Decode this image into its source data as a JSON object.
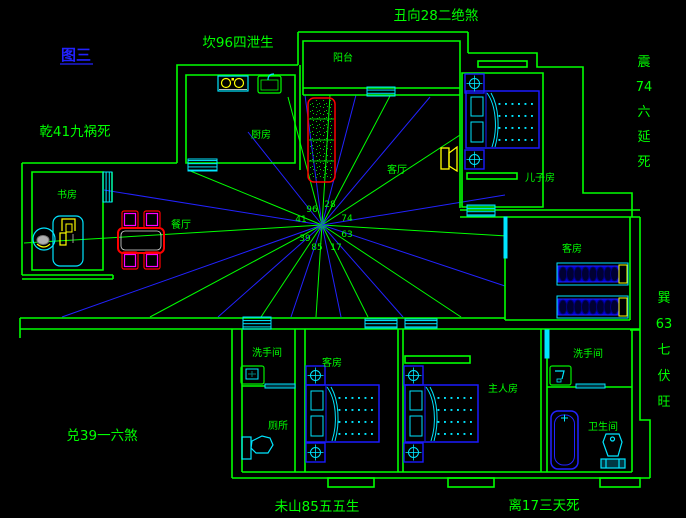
{
  "drawing_title": {
    "label": "图三"
  },
  "fengshui": {
    "top": "丑向28二绝煞",
    "north_west_upper": "坎96四泄生",
    "west_upper": "乾41九祸死",
    "west_lower": "兑39一六煞",
    "south_center": "未山85五五生",
    "south_east": "离17三天死",
    "east_upper_column": [
      "震",
      "74",
      "六",
      "延",
      "死"
    ],
    "east_lower_column": [
      "巽",
      "63",
      "七",
      "伏",
      "旺"
    ]
  },
  "rooms": {
    "balcony": {
      "label": "阳台"
    },
    "kitchen": {
      "label": "厨房"
    },
    "living": {
      "label": "客厅"
    },
    "son_room": {
      "label": "儿子房"
    },
    "study": {
      "label": "书房"
    },
    "dining": {
      "label": "餐厅"
    },
    "guest_right": {
      "label": "客房"
    },
    "washroom_left": {
      "label": "洗手间"
    },
    "toilet": {
      "label": "厕所"
    },
    "guest_bottom": {
      "label": "客房"
    },
    "master": {
      "label": "主人房"
    },
    "washroom_right": {
      "label": "洗手间"
    },
    "bathroom": {
      "label": "卫生间"
    }
  },
  "compass": {
    "center": {
      "x": 322,
      "y": 225
    },
    "numbers": [
      {
        "value": "96",
        "x": 312,
        "y": 212
      },
      {
        "value": "28",
        "x": 330,
        "y": 207
      },
      {
        "value": "41",
        "x": 301,
        "y": 222
      },
      {
        "value": "74",
        "x": 347,
        "y": 221
      },
      {
        "value": "39",
        "x": 305,
        "y": 241
      },
      {
        "value": "63",
        "x": 347,
        "y": 237
      },
      {
        "value": "85",
        "x": 317,
        "y": 250
      },
      {
        "value": "17",
        "x": 336,
        "y": 250
      }
    ],
    "rays": [
      {
        "x2": 507,
        "y2": 236,
        "color": "green"
      },
      {
        "x2": 505,
        "y2": 286,
        "color": "blue"
      },
      {
        "x2": 461,
        "y2": 317,
        "color": "green"
      },
      {
        "x2": 403,
        "y2": 317,
        "color": "blue"
      },
      {
        "x2": 368,
        "y2": 317,
        "color": "green"
      },
      {
        "x2": 341,
        "y2": 317,
        "color": "blue"
      },
      {
        "x2": 316,
        "y2": 317,
        "color": "green"
      },
      {
        "x2": 291,
        "y2": 317,
        "color": "blue"
      },
      {
        "x2": 261,
        "y2": 317,
        "color": "green"
      },
      {
        "x2": 218,
        "y2": 317,
        "color": "blue"
      },
      {
        "x2": 150,
        "y2": 317,
        "color": "green"
      },
      {
        "x2": 62,
        "y2": 317,
        "color": "blue"
      },
      {
        "x2": 24,
        "y2": 243,
        "color": "green"
      },
      {
        "x2": 104,
        "y2": 190,
        "color": "blue"
      },
      {
        "x2": 188,
        "y2": 170,
        "color": "green"
      },
      {
        "x2": 248,
        "y2": 132,
        "color": "blue"
      },
      {
        "x2": 288,
        "y2": 97,
        "color": "green"
      },
      {
        "x2": 305,
        "y2": 95,
        "color": "blue"
      },
      {
        "x2": 330,
        "y2": 95,
        "color": "green"
      },
      {
        "x2": 356,
        "y2": 95,
        "color": "blue"
      },
      {
        "x2": 390,
        "y2": 96,
        "color": "green"
      },
      {
        "x2": 430,
        "y2": 97,
        "color": "blue"
      },
      {
        "x2": 460,
        "y2": 135,
        "color": "green"
      },
      {
        "x2": 505,
        "y2": 195,
        "color": "blue"
      }
    ]
  },
  "colors": {
    "background": "#000000",
    "wall_green": "#00ff00",
    "ray_blue": "#2222ff",
    "furniture_blue": "#1a1aff",
    "cyan": "#00e5ff",
    "red": "#ff0000",
    "magenta": "#ff00ff",
    "yellow": "#ffff00",
    "title_blue": "#2222ff"
  }
}
